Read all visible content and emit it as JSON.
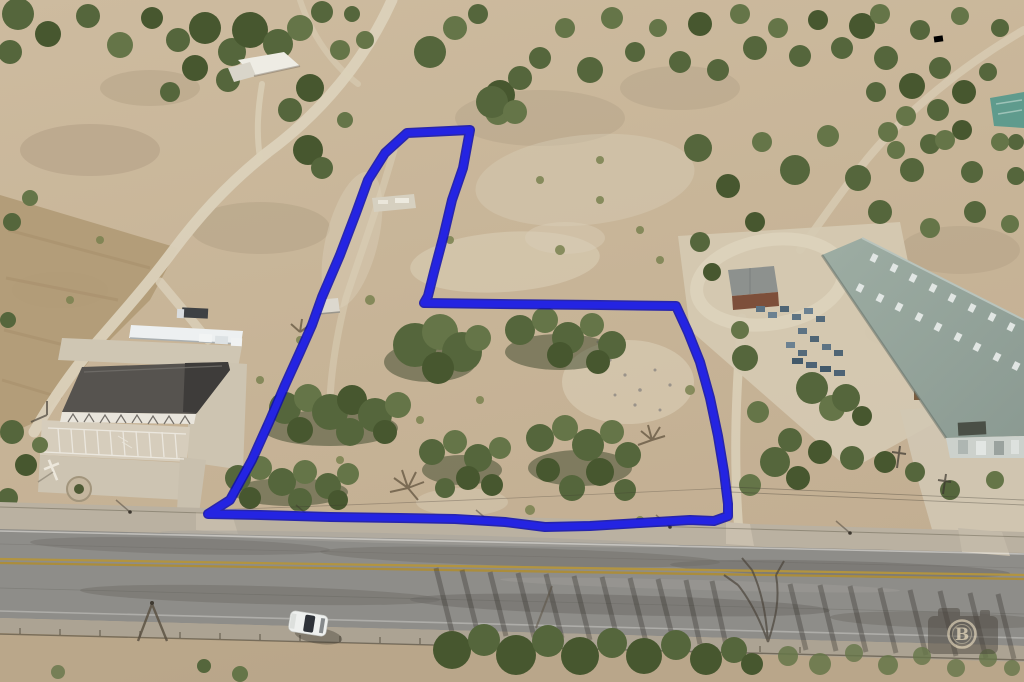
{
  "scene": {
    "type": "aerial-drone-photo",
    "description": "Aerial drone photograph of a vacant land parcel outlined in blue beside a two-lane highway, between a church property with parking lot and a large metal warehouse, surrounded by dry Texas scrubland with scattered cedar and mesquite trees",
    "objects": [
      "two-lane highway with double yellow centerline",
      "blue property boundary outline (L-shaped parcel)",
      "church building with shingle roof and striped parking lot",
      "white metal carport with parked trucks",
      "large gray-green metal warehouse with roof skylights",
      "small storage shed with rusted side",
      "circular gravel driveway",
      "stacked blue pallets and brown crates",
      "white SUV parked on highway shoulder",
      "dirt ranch roads",
      "concrete slab remains inside parcel",
      "photographer camera watermark"
    ]
  },
  "boundary": {
    "points": "407,133 470,130 463,168 452,200 443,238 434,272 428,296 424,303 500,304 600,305 676,306 688,332 700,362 710,398 718,436 724,472 728,504 728,516 714,521 690,520 640,523 590,526 545,527 505,522 455,519 400,518 330,517 260,515 208,514 230,500 252,460 270,420 285,385 300,352 312,325 322,297 340,255 356,213 368,180 385,153 396,143",
    "stroke_color": "#2424e2",
    "outline_color": "#0d0dad",
    "stroke_width": 7
  },
  "watermark": {
    "letter": "B",
    "shape": "camera-with-circle-monogram",
    "color": "#d6c9ae"
  },
  "vehicle": {
    "type": "white SUV",
    "location": "north shoulder of highway"
  },
  "colors": {
    "terrain": "#c8b69a",
    "field": "#b09a76",
    "trees": "#55663c",
    "asphalt": "#8e8d89",
    "centerline": "#b29440",
    "concrete": "#d0c7b5",
    "warehouse_roof": "#95a49b",
    "church_roof": "#56534f",
    "boundary_blue": "#2424e2"
  }
}
